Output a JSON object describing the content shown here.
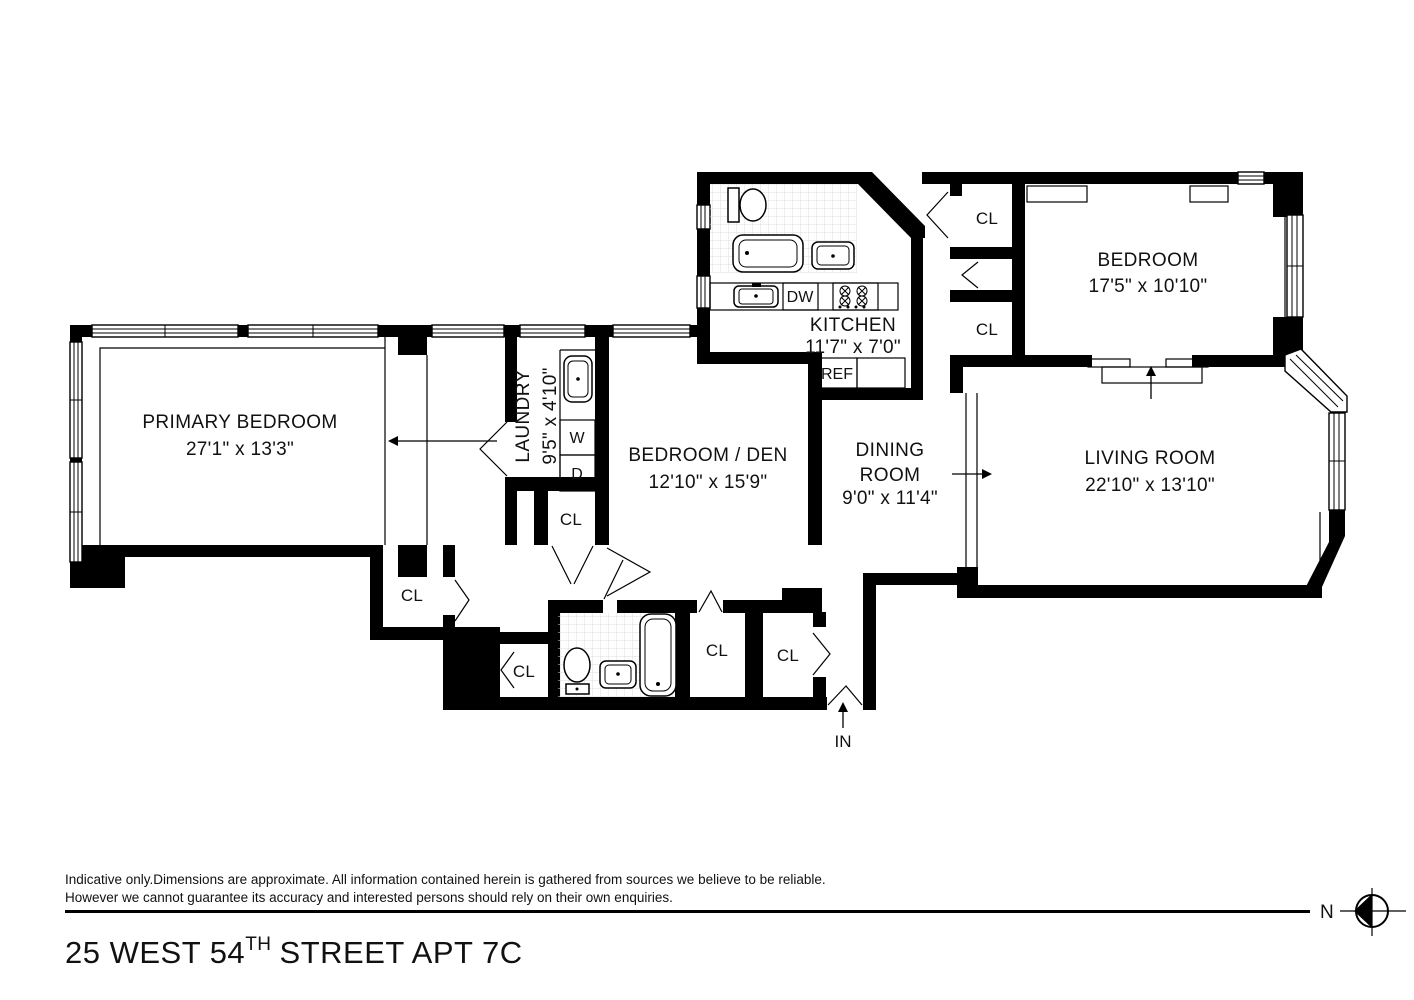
{
  "plan": {
    "primary_bedroom": {
      "name": "PRIMARY BEDROOM",
      "dims": "27'1\" x 13'3\""
    },
    "laundry": {
      "name": "LAUNDRY",
      "dims": "9'5\" x 4'10\""
    },
    "bedroom_den": {
      "name": "BEDROOM / DEN",
      "dims": "12'10\" x 15'9\""
    },
    "kitchen": {
      "name": "KITCHEN",
      "dims": "11'7\" x 7'0\""
    },
    "dining_room": {
      "name_line1": "DINING",
      "name_line2": "ROOM",
      "dims": "9'0\" x 11'4\""
    },
    "bedroom": {
      "name": "BEDROOM",
      "dims": "17'5\" x 10'10\""
    },
    "living_room": {
      "name": "LIVING ROOM",
      "dims": "22'10\" x 13'10\""
    },
    "closet_label": "CL",
    "washer_label": "W",
    "dryer_label": "D",
    "dishwasher_label": "DW",
    "refrigerator_label": "REF",
    "entry_label": "IN"
  },
  "footer": {
    "disclaimer_line1": "Indicative only.Dimensions are approximate. All information contained herein is gathered from sources we believe to be reliable.",
    "disclaimer_line2": "However we cannot guarantee its accuracy and interested persons should rely on their own enquiries.",
    "title_part1": "25 WEST 54",
    "title_sup": "TH",
    "title_part2": "STREET APT 7C",
    "north_label": "N"
  }
}
